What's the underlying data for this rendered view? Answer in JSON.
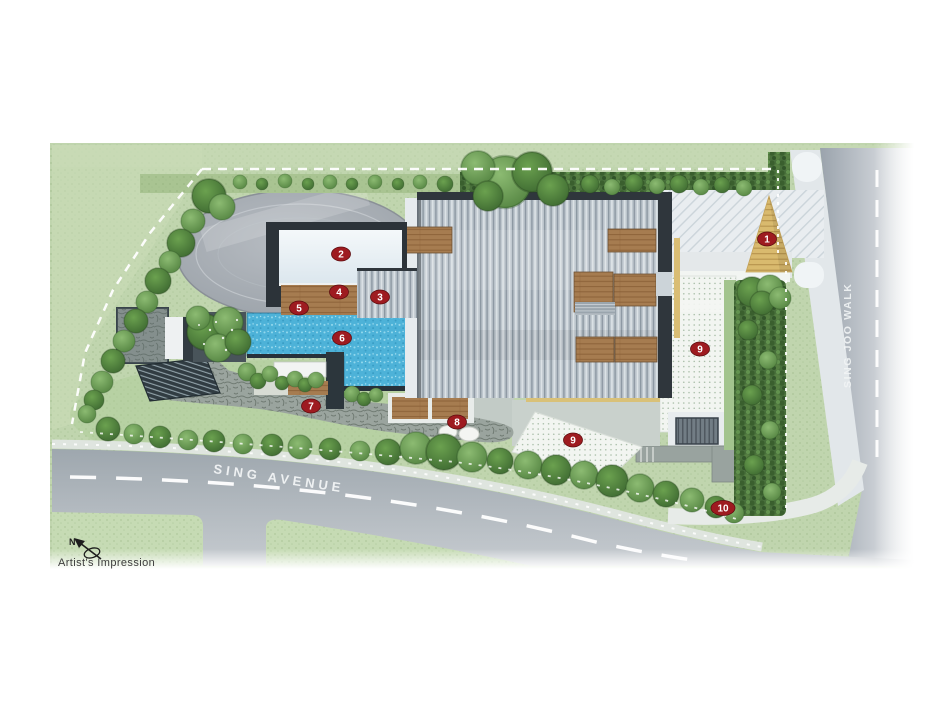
{
  "caption": {
    "artists_impression": "Artist's Impression",
    "compass_north": "N"
  },
  "streets": {
    "bottom_road": "SING AVENUE",
    "right_road": "SING JOO WALK"
  },
  "markers": [
    {
      "label": "1"
    },
    {
      "label": "2"
    },
    {
      "label": "3"
    },
    {
      "label": "4"
    },
    {
      "label": "5"
    },
    {
      "label": "6"
    },
    {
      "label": "7"
    },
    {
      "label": "8"
    },
    {
      "label": "9"
    },
    {
      "label": "9"
    },
    {
      "label": "10"
    }
  ],
  "colors": {
    "marker_red": "#9e1b20",
    "pool_blue": "#4fb3d9",
    "lawn_green": "#c0d5ae",
    "hedge_green": "#4a7540",
    "road_gray": "#a7b0b8",
    "wood_deck": "#a87c50",
    "entrance_timber": "#d9ba6e",
    "roof_gray": "#bdc6cd"
  }
}
